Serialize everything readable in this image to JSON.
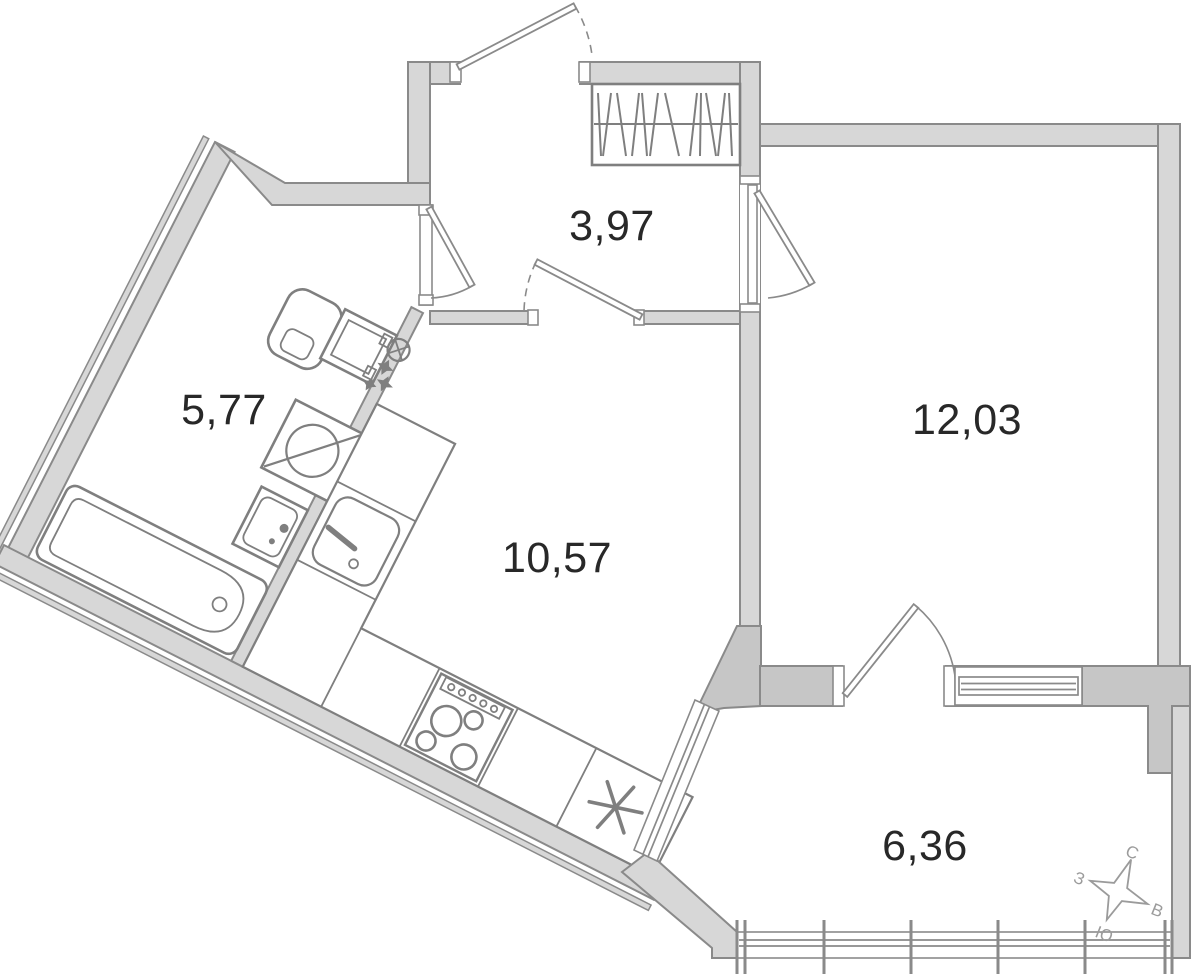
{
  "document": {
    "type": "apartment floor plan"
  },
  "rooms": [
    {
      "name": "hallway",
      "area": "3,97"
    },
    {
      "name": "bathroom",
      "area": "5,77"
    },
    {
      "name": "kitchen",
      "area": "10,57"
    },
    {
      "name": "room",
      "area": "12,03"
    },
    {
      "name": "balcony",
      "area": "6,36"
    }
  ],
  "compass": {
    "north": "С",
    "east": "В",
    "south": "Ю",
    "west": "З"
  },
  "fixtures": [
    "wardrobe",
    "toilet",
    "washing-machine",
    "bathroom-sink",
    "bathtub",
    "kitchen-counter",
    "kitchen-sink",
    "stove",
    "refrigerator"
  ],
  "colors": {
    "background": "#ffffff",
    "wall_light": "#d7d7d7",
    "wall_dark": "#c6c6c6",
    "outline": "#8a8a8a",
    "fixture": "#7f7f7f",
    "label": "#282828",
    "compass": "#9b9b9b"
  }
}
